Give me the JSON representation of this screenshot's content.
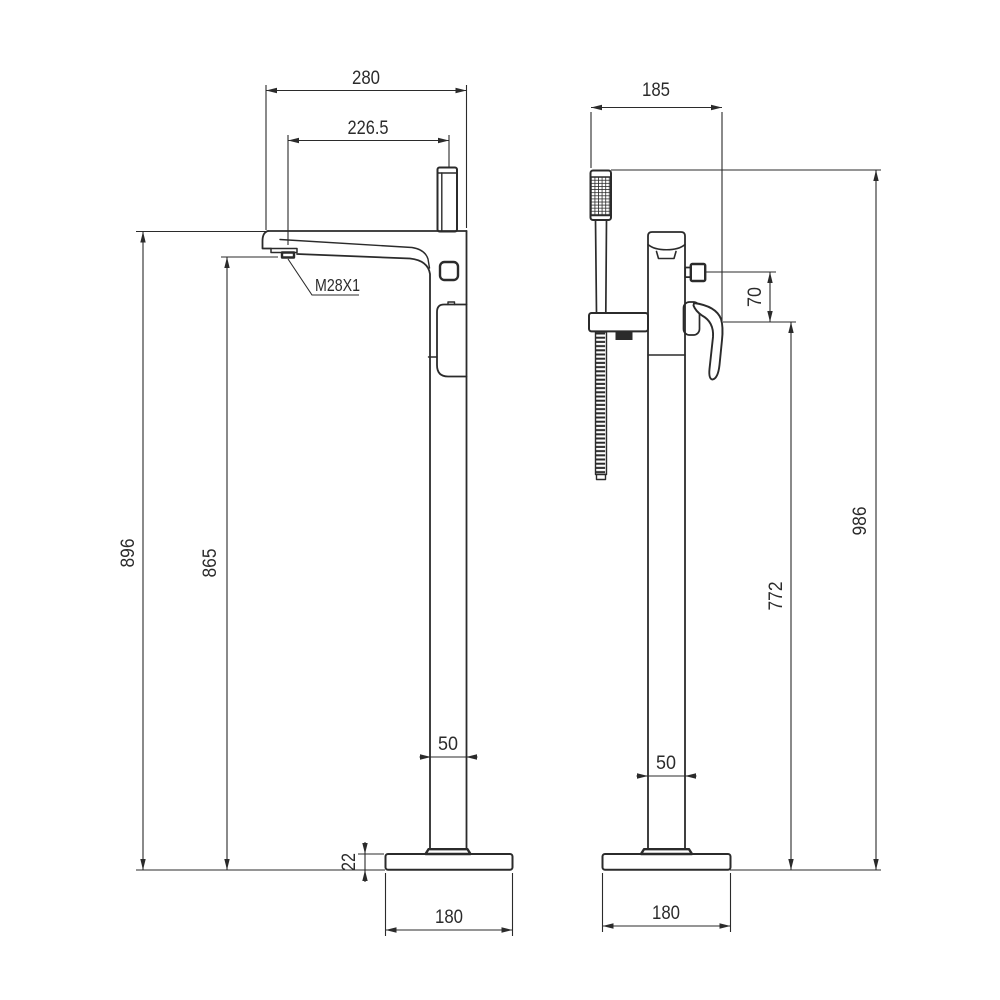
{
  "page": {
    "background": "#ffffff",
    "line_color": "#2b2b2b"
  },
  "drawing": {
    "type": "technical-drawing",
    "subject": "Freestanding bath shower mixer tap - front and side elevations",
    "units": "mm",
    "views": {
      "front": {
        "title": "front-elevation",
        "dimensions": {
          "spout_width_top": "280",
          "spout_reach": "226.5",
          "outlet_thread": "M28X1",
          "height_body_top": "896",
          "height_spout_outlet": "865",
          "column_width": "50",
          "base_thickness": "22",
          "base_width": "180"
        }
      },
      "side": {
        "title": "side-elevation",
        "dimensions": {
          "depth_overall": "185",
          "diverter_offset": "70",
          "height_overall": "986",
          "height_lever_ref": "772",
          "column_depth": "50",
          "base_width": "180"
        }
      }
    }
  }
}
